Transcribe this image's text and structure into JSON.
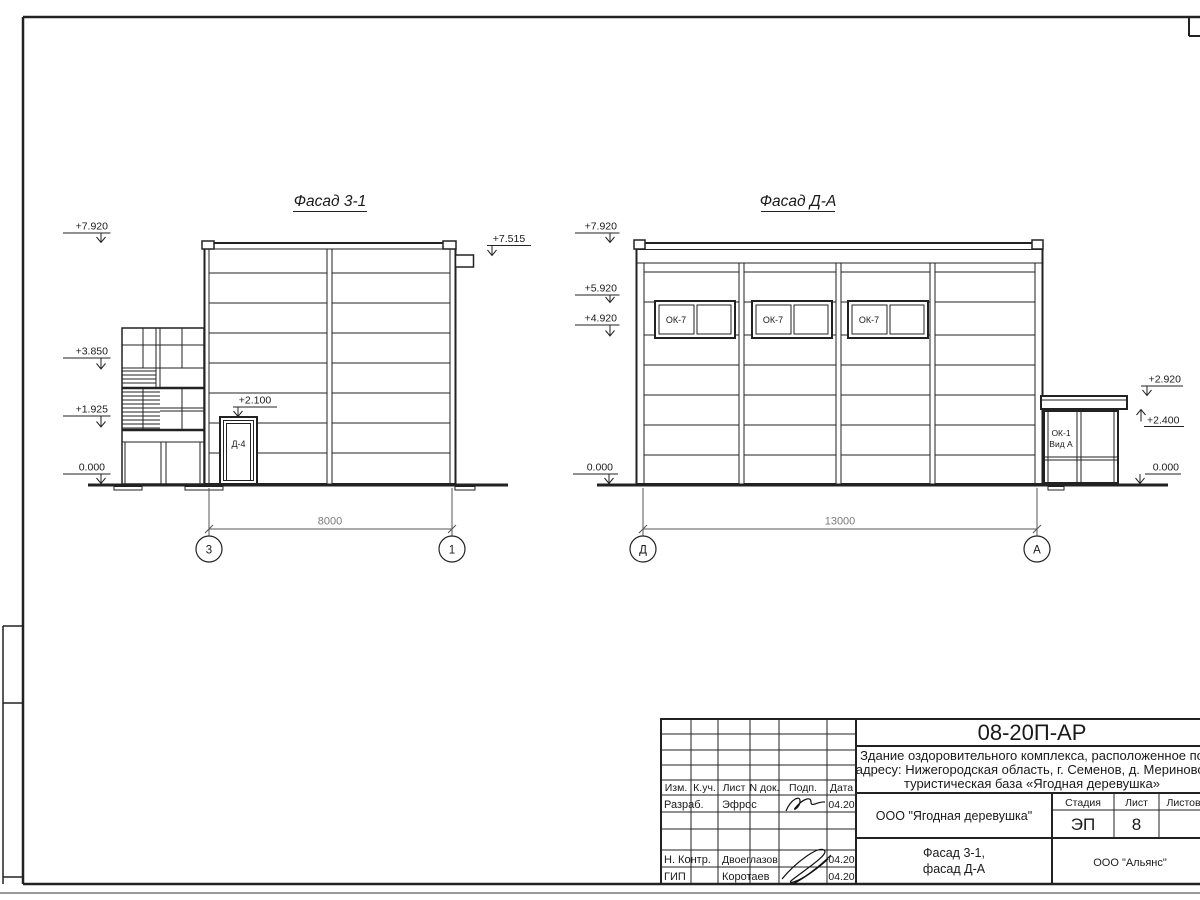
{
  "drawing": {
    "facade31": {
      "title": "Фасад 3-1",
      "elev_top": "+7.920",
      "elev_roof_right": "+7.515",
      "elev_mid": "+3.850",
      "elev_low": "+1.925",
      "elev_zero": "0.000",
      "elev_door": "+2.100",
      "door_label": "Д-4",
      "dim": "8000",
      "axis_left": "3",
      "axis_right": "1"
    },
    "facadeDA": {
      "title": "Фасад Д-А",
      "elev_top": "+7.920",
      "elev_win_top": "+5.920",
      "elev_win_bottom": "+4.920",
      "elev_zero_left": "0.000",
      "elev_canopy": "+2.920",
      "elev_porch": "+2.400",
      "elev_zero_right": "0.000",
      "window_label": "ОК-7",
      "porch_label_1": "ОК-1",
      "porch_label_2": "Вид А",
      "dim": "13000",
      "axis_left": "Д",
      "axis_right": "А"
    }
  },
  "title_block": {
    "doc_number": "08-20П-АР",
    "project_line1": "Здание оздоровительного комплекса, расположенное по",
    "project_line2": "адресу: Нижегородская область, г. Семенов, д. Мериново,",
    "project_line3": "туристическая база «Ягодная деревушка»",
    "organization": "ООО \"Ягодная деревушка\"",
    "sheet_name_1": "Фасад 3-1,",
    "sheet_name_2": "фасад Д-А",
    "contractor": "ООО \"Альянс\"",
    "stage_label": "Стадия",
    "list_label": "Лист",
    "listov_label": "Листов",
    "stage_value": "ЭП",
    "list_value": "8",
    "col_izm": "Изм.",
    "col_kuch": "К.уч.",
    "col_list": "Лист",
    "col_ndok": "N док.",
    "col_podp": "Подп.",
    "col_data": "Дата",
    "razrab_label": "Разраб.",
    "razrab_name": "Эфрос",
    "razrab_date": "04.20",
    "nkontr_label": "Н. Контр.",
    "nkontr_name": "Двоеглазов",
    "nkontr_date": "04.20",
    "gip_label": "ГИП",
    "gip_name": "Коротаев",
    "gip_date": "04.20"
  }
}
